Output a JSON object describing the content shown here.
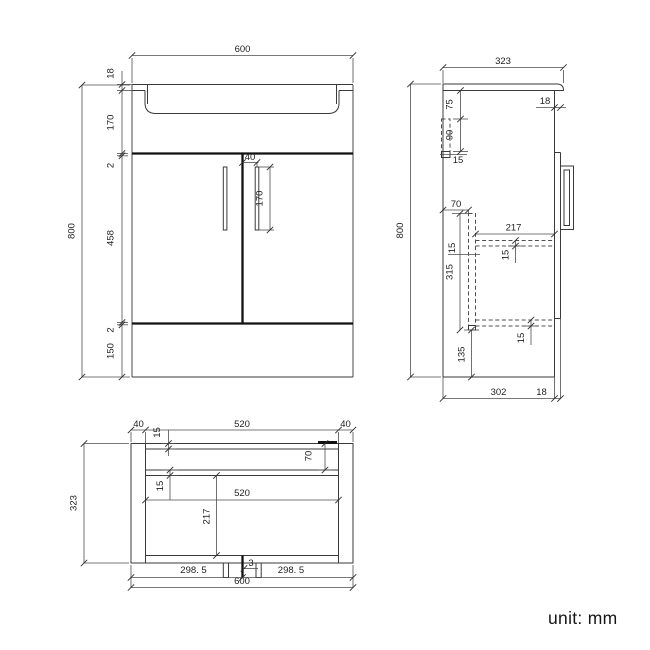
{
  "footer": {
    "unit_label": "unit: mm"
  },
  "front_view": {
    "width": "600",
    "height": "800",
    "top_thickness": "18",
    "basin_depth": "170",
    "gap_top": "2",
    "door_height": "458",
    "gap_bottom": "2",
    "plinth_height": "150",
    "handle_offset": "40",
    "handle_length": "170"
  },
  "side_view": {
    "depth": "323",
    "height": "800",
    "door_thickness_top": "18",
    "bracket_offset": "75",
    "bracket_height": "90",
    "bracket_rail_thickness": "15",
    "rail_offset": "70",
    "shelf_depth": "217",
    "shelf_thickness": "15",
    "rail_height": "315",
    "rail_thickness": "15",
    "bottom_shelf_thickness": "15",
    "plinth_space": "135",
    "body_depth": "302",
    "door_thickness_bottom": "18"
  },
  "plan_view": {
    "left_panel": "40",
    "inner_width_top": "520",
    "right_panel": "40",
    "back_thickness": "15",
    "rail_offset": "70",
    "rail_thickness": "15",
    "inner_width": "520",
    "interior_depth": "217",
    "depth": "323",
    "door_gap": "3",
    "left_half": "298. 5",
    "right_half": "298. 5",
    "width": "600"
  }
}
